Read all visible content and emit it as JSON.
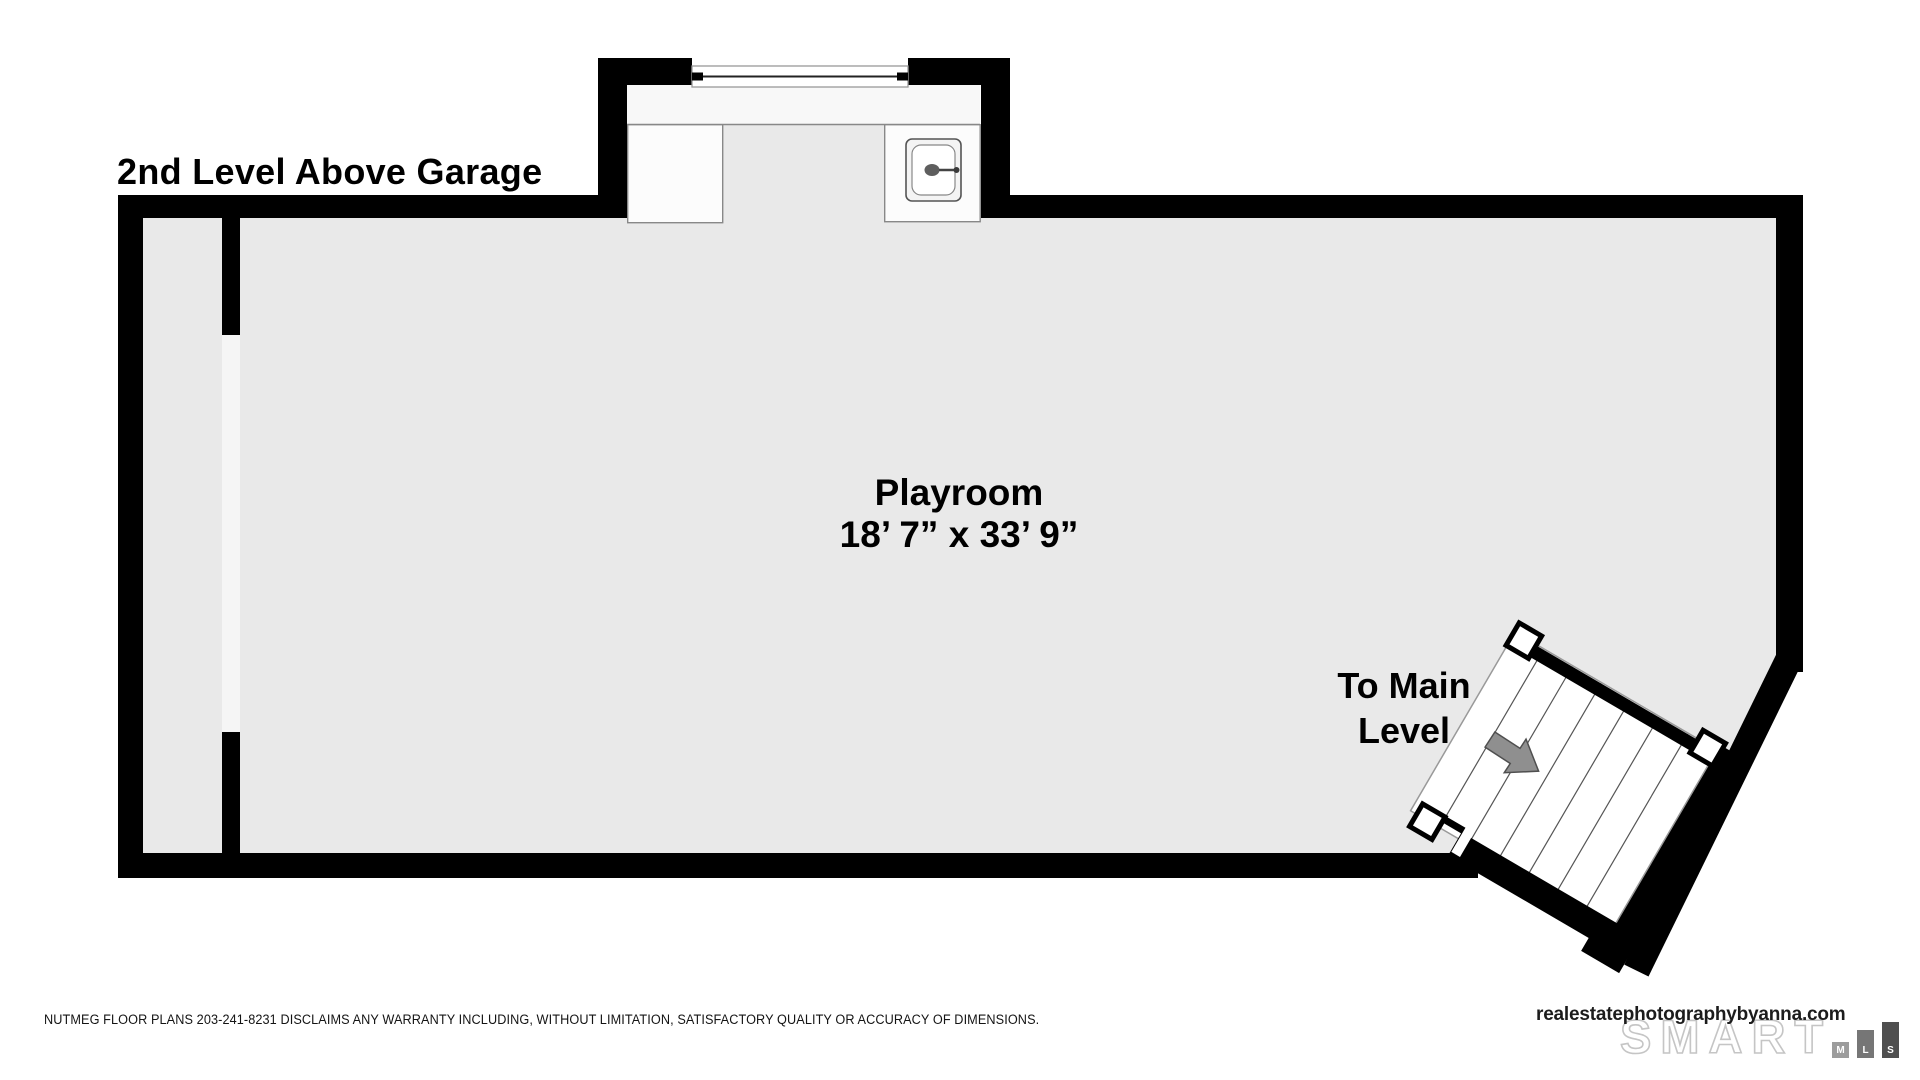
{
  "title": "2nd Level Above Garage",
  "room": {
    "name": "Playroom",
    "dimensions": "18’ 7” x 33’ 9”"
  },
  "stairs": {
    "label": "To Main\nLevel",
    "direction_icon": "arrow-down-right-icon"
  },
  "fixtures": {
    "sink_icon": "sink-icon",
    "window_icon": "window-icon"
  },
  "footer": {
    "disclaimer": "NUTMEG FLOOR PLANS 203-241-8231 DISCLAIMS ANY WARRANTY INCLUDING, WITHOUT LIMITATION, SATISFACTORY QUALITY OR ACCURACY OF DIMENSIONS."
  },
  "branding": {
    "website": "realestatephotographybyanna.com",
    "logo_word": "SMART",
    "logo_letters": [
      "M",
      "L",
      "S"
    ]
  },
  "colors": {
    "wall": "#000000",
    "floor": "#e9e9e9",
    "counter": "#f8f8f8",
    "door_opening": "#f5f5f5",
    "arrow": "#8f8f8f",
    "logo_outline": "#c5c5c5",
    "mls_bar_m": "#9c9c9c",
    "mls_bar_l": "#767676",
    "mls_bar_s": "#4f4f4f"
  }
}
